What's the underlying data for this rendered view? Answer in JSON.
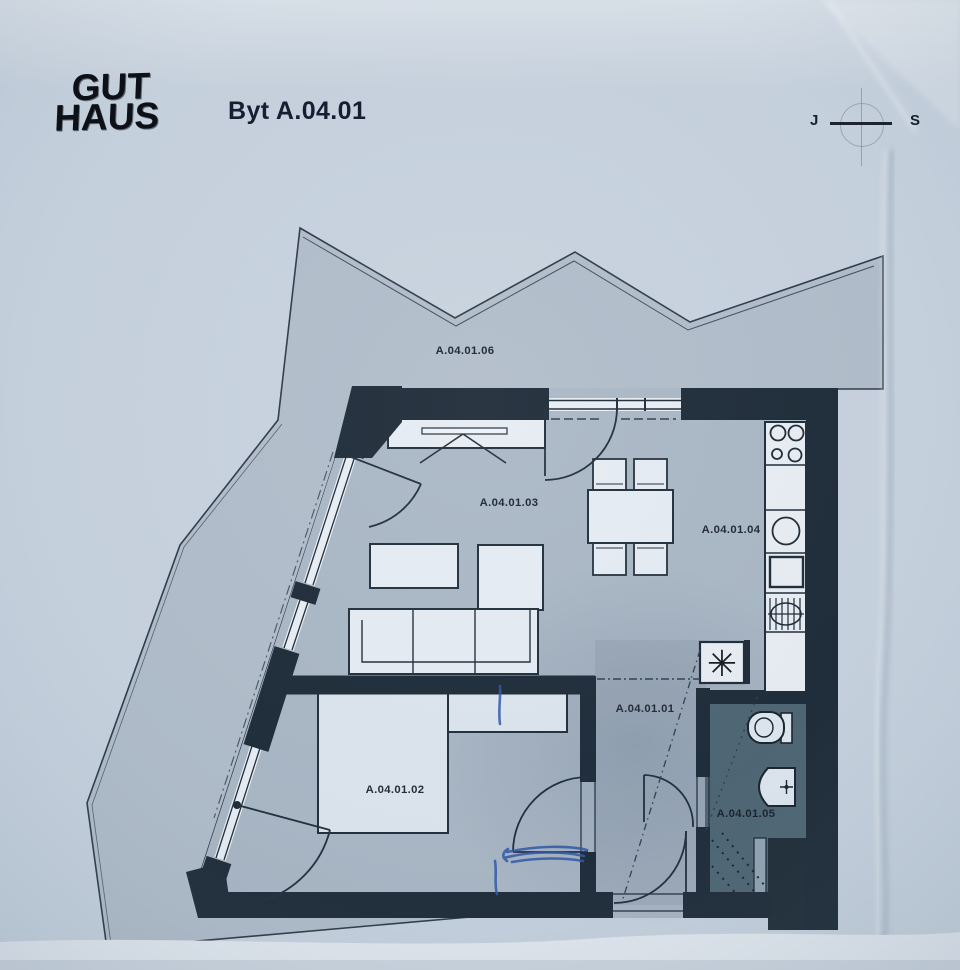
{
  "header": {
    "logo_line1": "GUT",
    "logo_line2": "HAUS",
    "title": "Byt A.04.01"
  },
  "compass": {
    "left_letter": "J",
    "right_letter": "S"
  },
  "rooms": {
    "hall": {
      "label": "A.04.01.01"
    },
    "bedroom": {
      "label": "A.04.01.02"
    },
    "living": {
      "label": "A.04.01.03"
    },
    "kitchen": {
      "label": "A.04.01.04"
    },
    "bathroom": {
      "label": "A.04.01.05"
    },
    "terrace": {
      "label": "A.04.01.06"
    }
  },
  "symbols": {
    "washing_machine": "✳"
  },
  "colors": {
    "paper": "#c7d2de",
    "terrace_floor": "#b0bcc9",
    "room_floor": "#a9b6c4",
    "bathroom_floor": "#4b6371",
    "wall": "#1a2734",
    "furniture_fill": "#e6ecf3",
    "pen_annotation": "#2d55a6",
    "label_text": "#262e3c"
  }
}
